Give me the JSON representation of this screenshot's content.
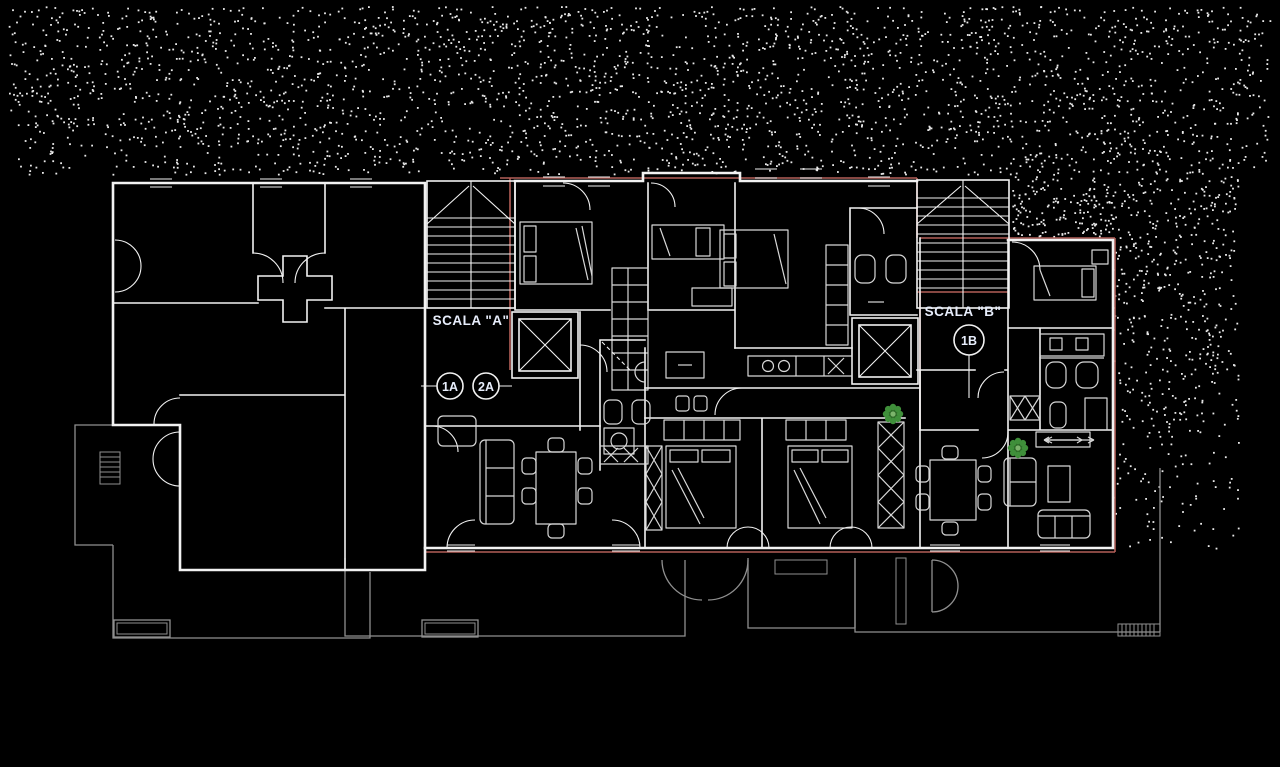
{
  "drawing": {
    "type": "architectural floor plan (CAD, dark background)",
    "labels": {
      "stair_a": "SCALA \"A\"",
      "stair_b": "SCALA \"B\"",
      "unit_1a": "1A",
      "unit_2a": "2A",
      "unit_1b": "1B"
    },
    "colors": {
      "background": "#000000",
      "walls": "#f2f2f2",
      "furniture": "#d8d8d8",
      "terrace_gray": "#8f8f8f",
      "boundary_red": "#b35f58",
      "plant_green": "#3f8f3a",
      "plant_green_dark": "#2e6b28",
      "plant_green_light": "#7cb46c",
      "label_text": "#e7edfb"
    }
  }
}
